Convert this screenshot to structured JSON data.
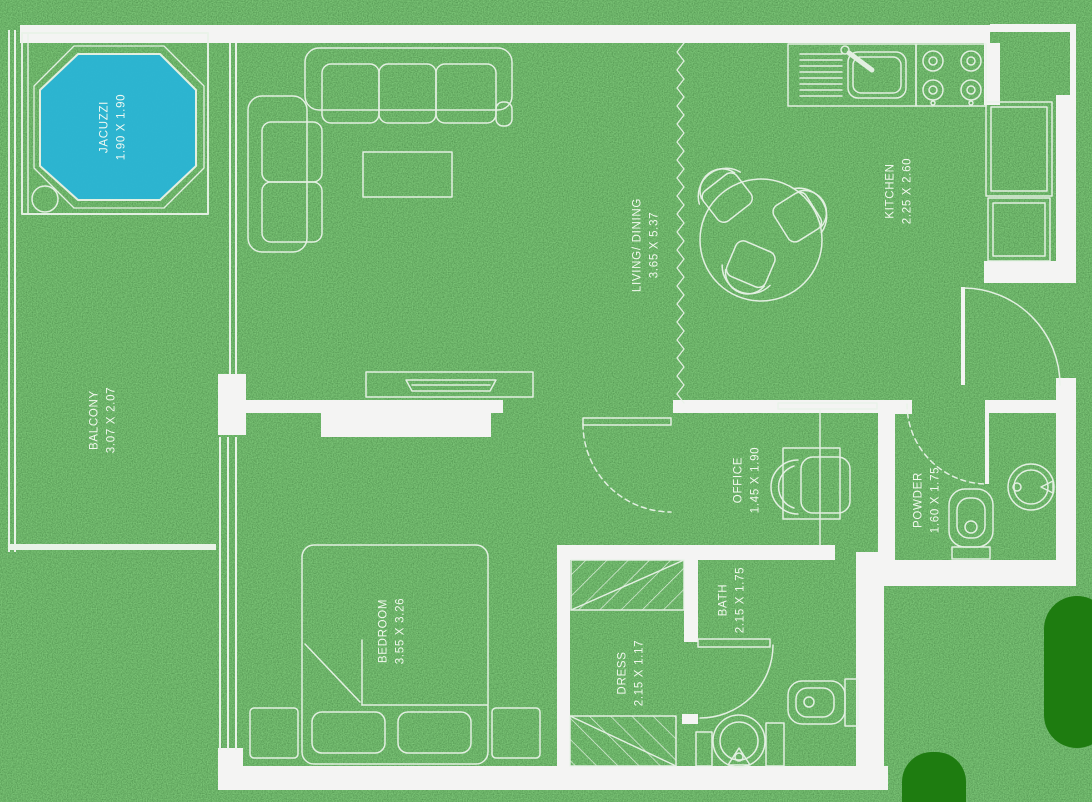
{
  "floor_plan": {
    "title": "apartment-floor-plan-on-grass",
    "rooms": [
      {
        "id": "jacuzzi",
        "name": "JACUZZI",
        "dims": "1.90 X 1.90"
      },
      {
        "id": "balcony",
        "name": "BALCONY",
        "dims": "3.07 X 2.07"
      },
      {
        "id": "living_dining",
        "name": "LIVING/ DINING",
        "dims": "3.65 X 5.37"
      },
      {
        "id": "kitchen",
        "name": "KITCHEN",
        "dims": "2.25 X 2.60"
      },
      {
        "id": "office",
        "name": "OFFICE",
        "dims": "1.45 X 1.90"
      },
      {
        "id": "powder",
        "name": "POWDER",
        "dims": "1.60 X 1.75"
      },
      {
        "id": "bedroom",
        "name": "BEDROOM",
        "dims": "3.55 X 3.26"
      },
      {
        "id": "dress",
        "name": "DRESS",
        "dims": "2.15 X 1.17"
      },
      {
        "id": "bath",
        "name": "BATH",
        "dims": "2.15 X 1.75"
      }
    ],
    "colors": {
      "grass_base": "#2e7b31",
      "wall_white": "#f4f4f3",
      "line_white": "#e9f3e8",
      "jacuzzi_fill": "#2ab5d6",
      "bush_green": "#1e7c10",
      "label_text": "#f7fbf4"
    },
    "furniture": [
      "sofa-l-shaped",
      "coffee-table",
      "tv-console",
      "dining-table-3-chairs",
      "kitchen-sink",
      "stove-4-burner",
      "counter",
      "fridge",
      "desk",
      "office-chair",
      "double-bed",
      "pillows",
      "nightstands",
      "wardrobe-hatched",
      "toilet",
      "washbasin",
      "jacuzzi-octagon"
    ]
  }
}
